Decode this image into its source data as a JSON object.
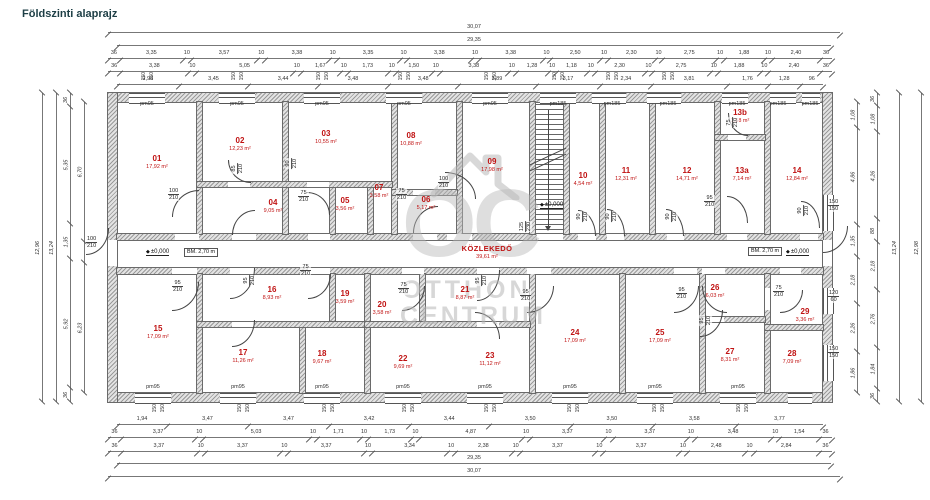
{
  "title": "Földszinti alaprajz",
  "watermark": {
    "logo": "OC",
    "line1": "OTTHON",
    "line2": "CENTRUM"
  },
  "labels": {
    "pm95": "pm95",
    "pm185": "pm185",
    "w150": "150",
    "level": "±0,000",
    "bm": "BM. 2,70 m"
  },
  "corridor": {
    "name": "KÖZLEKEDŐ",
    "area": "39,61 m²"
  },
  "rooms": [
    {
      "no": "01",
      "area": "17,92 m²"
    },
    {
      "no": "02",
      "area": "12,23 m²"
    },
    {
      "no": "03",
      "area": "10,55 m²"
    },
    {
      "no": "04",
      "area": "9,05 m²"
    },
    {
      "no": "05",
      "area": "3,56 m²"
    },
    {
      "no": "06",
      "area": "5,17 m²"
    },
    {
      "no": "07",
      "area": "3,58 m²"
    },
    {
      "no": "08",
      "area": "10,88 m²"
    },
    {
      "no": "09",
      "area": "17,98 m²"
    },
    {
      "no": "10",
      "area": "4,54 m²"
    },
    {
      "no": "11",
      "area": "12,31 m²"
    },
    {
      "no": "12",
      "area": "14,71 m²"
    },
    {
      "no": "13a",
      "area": "7,14 m²"
    },
    {
      "no": "13b",
      "area": "1,58 m²"
    },
    {
      "no": "14",
      "area": "12,84 m²"
    },
    {
      "no": "15",
      "area": "17,09 m²"
    },
    {
      "no": "16",
      "area": "8,93 m²"
    },
    {
      "no": "17",
      "area": "11,26 m²"
    },
    {
      "no": "18",
      "area": "9,67 m²"
    },
    {
      "no": "19",
      "area": "3,59 m²"
    },
    {
      "no": "20",
      "area": "3,58 m²"
    },
    {
      "no": "21",
      "area": "8,87 m²"
    },
    {
      "no": "22",
      "area": "9,69 m²"
    },
    {
      "no": "23",
      "area": "11,12 m²"
    },
    {
      "no": "24",
      "area": "17,09 m²"
    },
    {
      "no": "25",
      "area": "17,09 m²"
    },
    {
      "no": "26",
      "area": "6,03 m²"
    },
    {
      "no": "27",
      "area": "8,31 m²"
    },
    {
      "no": "28",
      "area": "7,09 m²"
    },
    {
      "no": "29",
      "area": "3,36 m²"
    }
  ],
  "fracs": [
    {
      "t": "100",
      "b": "210"
    },
    {
      "t": "100",
      "b": "210"
    },
    {
      "t": "75",
      "b": "210"
    },
    {
      "t": "75",
      "b": "210"
    },
    {
      "t": "100",
      "b": "210"
    },
    {
      "t": "95",
      "b": "210"
    },
    {
      "t": "95",
      "b": "210"
    },
    {
      "t": "75",
      "b": "210"
    },
    {
      "t": "75",
      "b": "210"
    },
    {
      "t": "95",
      "b": "210"
    },
    {
      "t": "95",
      "b": "210"
    },
    {
      "t": "75",
      "b": "210"
    },
    {
      "t": "150",
      "b": "150"
    },
    {
      "t": "120",
      "b": "60"
    },
    {
      "t": "150",
      "b": "150"
    },
    {
      "t": "95",
      "b": "210"
    },
    {
      "t": "95",
      "b": "210"
    },
    {
      "t": "85",
      "b": "210"
    },
    {
      "t": "90",
      "b": "210"
    },
    {
      "t": "90",
      "b": "210"
    },
    {
      "t": "90",
      "b": "210"
    },
    {
      "t": "90",
      "b": "210"
    },
    {
      "t": "90",
      "b": "210"
    },
    {
      "t": "125",
      "b": "230"
    },
    {
      "t": "75",
      "b": "210"
    },
    {
      "t": "95",
      "b": "210"
    }
  ],
  "dims": {
    "top1": [
      {
        "v": "30,07",
        "w": 1
      }
    ],
    "top2": [
      {
        "v": "29,35",
        "w": 1
      }
    ],
    "top3": [
      {
        "v": "36",
        "w": 0.36
      },
      {
        "v": "3,35",
        "w": 3.35
      },
      {
        "v": "10",
        "w": 0.1
      },
      {
        "v": "3,57",
        "w": 3.57
      },
      {
        "v": "10",
        "w": 0.1
      },
      {
        "v": "3,38",
        "w": 3.38
      },
      {
        "v": "10",
        "w": 0.1
      },
      {
        "v": "3,35",
        "w": 3.35
      },
      {
        "v": "10",
        "w": 0.1
      },
      {
        "v": "3,38",
        "w": 3.38
      },
      {
        "v": "10",
        "w": 0.1
      },
      {
        "v": "3,38",
        "w": 3.38
      },
      {
        "v": "10",
        "w": 0.1
      },
      {
        "v": "2,50",
        "w": 2.5
      },
      {
        "v": "10",
        "w": 0.1
      },
      {
        "v": "2,30",
        "w": 2.3
      },
      {
        "v": "10",
        "w": 0.1
      },
      {
        "v": "2,75",
        "w": 2.75
      },
      {
        "v": "10",
        "w": 0.1
      },
      {
        "v": "1,88",
        "w": 1.88
      },
      {
        "v": "10",
        "w": 0.1
      },
      {
        "v": "2,40",
        "w": 2.4
      },
      {
        "v": "36",
        "w": 0.36
      }
    ],
    "top4": [
      {
        "v": "36",
        "w": 0.36
      },
      {
        "v": "3,38",
        "w": 3.38
      },
      {
        "v": "10",
        "w": 0.1
      },
      {
        "v": "5,05",
        "w": 5.05
      },
      {
        "v": "10",
        "w": 0.1
      },
      {
        "v": "1,67",
        "w": 1.67
      },
      {
        "v": "10",
        "w": 0.1
      },
      {
        "v": "1,73",
        "w": 1.73
      },
      {
        "v": "10",
        "w": 0.1
      },
      {
        "v": "1,50",
        "w": 1.5
      },
      {
        "v": "10",
        "w": 0.1
      },
      {
        "v": "3,38",
        "w": 3.38
      },
      {
        "v": "10",
        "w": 0.1
      },
      {
        "v": "1,28",
        "w": 1.28
      },
      {
        "v": "10",
        "w": 0.1
      },
      {
        "v": "1,18",
        "w": 1.18
      },
      {
        "v": "10",
        "w": 0.1
      },
      {
        "v": "2,30",
        "w": 2.3
      },
      {
        "v": "10",
        "w": 0.1
      },
      {
        "v": "2,75",
        "w": 2.75
      },
      {
        "v": "10",
        "w": 0.1
      },
      {
        "v": "1,88",
        "w": 1.88
      },
      {
        "v": "10",
        "w": 0.1
      },
      {
        "v": "2,40",
        "w": 2.4
      },
      {
        "v": "36",
        "w": 0.36
      }
    ],
    "top5": [
      {
        "v": "2,98",
        "w": 2.98
      },
      {
        "v": "3,45",
        "w": 3.45
      },
      {
        "v": "3,44",
        "w": 3.44
      },
      {
        "v": "3,48",
        "w": 3.48
      },
      {
        "v": "3,48",
        "w": 3.48
      },
      {
        "v": "3,89",
        "w": 3.89
      },
      {
        "v": "3,17",
        "w": 3.17
      },
      {
        "v": "2,34",
        "w": 2.34
      },
      {
        "v": "3,81",
        "w": 3.81
      },
      {
        "v": "1,76",
        "w": 1.76
      },
      {
        "v": "1,28",
        "w": 1.28
      },
      {
        "v": "96",
        "w": 0.96
      }
    ],
    "botA": [
      {
        "v": "1,94",
        "w": 1.94
      },
      {
        "v": "3,47",
        "w": 3.47
      },
      {
        "v": "3,47",
        "w": 3.47
      },
      {
        "v": "3,42",
        "w": 3.42
      },
      {
        "v": "3,44",
        "w": 3.44
      },
      {
        "v": "3,50",
        "w": 3.5
      },
      {
        "v": "3,50",
        "w": 3.5
      },
      {
        "v": "3,58",
        "w": 3.58
      },
      {
        "v": "3,77",
        "w": 3.77
      }
    ],
    "botB": [
      {
        "v": "36",
        "w": 0.36
      },
      {
        "v": "3,37",
        "w": 3.37
      },
      {
        "v": "10",
        "w": 0.1
      },
      {
        "v": "5,03",
        "w": 5.03
      },
      {
        "v": "10",
        "w": 0.1
      },
      {
        "v": "1,71",
        "w": 1.71
      },
      {
        "v": "10",
        "w": 0.1
      },
      {
        "v": "1,73",
        "w": 1.73
      },
      {
        "v": "10",
        "w": 0.1
      },
      {
        "v": "4,87",
        "w": 4.87
      },
      {
        "v": "10",
        "w": 0.1
      },
      {
        "v": "3,37",
        "w": 3.37
      },
      {
        "v": "10",
        "w": 0.1
      },
      {
        "v": "3,37",
        "w": 3.37
      },
      {
        "v": "10",
        "w": 0.1
      },
      {
        "v": "3,48",
        "w": 3.48
      },
      {
        "v": "10",
        "w": 0.1
      },
      {
        "v": "1,54",
        "w": 1.54
      },
      {
        "v": "36",
        "w": 0.36
      }
    ],
    "botC": [
      {
        "v": "36",
        "w": 0.36
      },
      {
        "v": "3,37",
        "w": 3.37
      },
      {
        "v": "10",
        "w": 0.1
      },
      {
        "v": "3,37",
        "w": 3.37
      },
      {
        "v": "10",
        "w": 0.1
      },
      {
        "v": "3,37",
        "w": 3.37
      },
      {
        "v": "10",
        "w": 0.1
      },
      {
        "v": "3,34",
        "w": 3.34
      },
      {
        "v": "10",
        "w": 0.1
      },
      {
        "v": "2,38",
        "w": 2.38
      },
      {
        "v": "10",
        "w": 0.1
      },
      {
        "v": "3,37",
        "w": 3.37
      },
      {
        "v": "10",
        "w": 0.1
      },
      {
        "v": "3,37",
        "w": 3.37
      },
      {
        "v": "10",
        "w": 0.1
      },
      {
        "v": "2,48",
        "w": 2.48
      },
      {
        "v": "10",
        "w": 0.1
      },
      {
        "v": "2,84",
        "w": 2.84
      },
      {
        "v": "36",
        "w": 0.36
      }
    ],
    "botD": [
      {
        "v": "29,35",
        "w": 1
      }
    ],
    "botE": [
      {
        "v": "30,07",
        "w": 1
      }
    ],
    "l1": [
      {
        "v": "12,96",
        "w": 1
      }
    ],
    "l2": [
      {
        "v": "13,24",
        "w": 1
      }
    ],
    "l3": [
      {
        "v": "36",
        "w": 0.36
      },
      {
        "v": "5,35",
        "w": 5.35
      },
      {
        "v": "1,35",
        "w": 1.35
      },
      {
        "v": "5,92",
        "w": 5.92
      },
      {
        "v": "36",
        "w": 0.36
      }
    ],
    "l4": [
      {
        "v": "6,70",
        "w": 6.7
      },
      {
        "v": "",
        "w": 1.06
      },
      {
        "v": "6,23",
        "w": 6.23
      }
    ],
    "r1": [
      {
        "v": "1,08",
        "w": 1.08
      },
      {
        "v": "4,86",
        "w": 4.86
      },
      {
        "v": "1,35",
        "w": 1.35
      },
      {
        "v": "2,18",
        "w": 2.18
      },
      {
        "v": "2,26",
        "w": 2.26
      },
      {
        "v": "1,86",
        "w": 1.86
      }
    ],
    "r2": [
      {
        "v": "36",
        "w": 0.36
      },
      {
        "v": "1,08",
        "w": 1.08
      },
      {
        "v": "4,26",
        "w": 4.26
      },
      {
        "v": "88",
        "w": 0.88
      },
      {
        "v": "2,18",
        "w": 2.18
      },
      {
        "v": "2,76",
        "w": 2.76
      },
      {
        "v": "1,84",
        "w": 1.84
      },
      {
        "v": "36",
        "w": 0.36
      }
    ],
    "r3": [
      {
        "v": "13,24",
        "w": 1
      }
    ],
    "r4": [
      {
        "v": "12,98",
        "w": 1
      }
    ]
  }
}
